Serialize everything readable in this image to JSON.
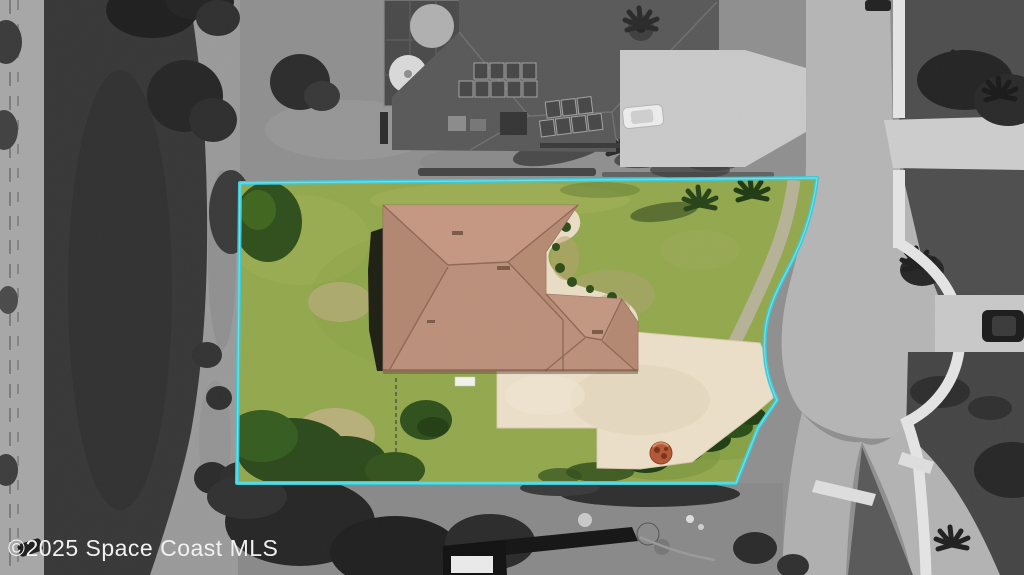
{
  "watermark": {
    "text": "©2025 Space Coast MLS"
  },
  "colors": {
    "boundary": "#3cc9d6",
    "boundary_inner": "#7ce7ee",
    "grass": "#92a84d",
    "tree_green": "#2f4f1c",
    "roof": "#bc907b",
    "roof_light": "#c99d87",
    "pavement": "#ebdfc8",
    "pond": "#373737",
    "road": "#b5b5b5",
    "sidewalk": "#e4e4e4",
    "field_gray": "#8f8f8f",
    "dark_lawn": "#4e4e4e",
    "neighbor_roof": "#595959",
    "neighbor_driveway": "#c9c9c9",
    "firepit": "#b25836",
    "watermark": "#f1f1f1"
  }
}
